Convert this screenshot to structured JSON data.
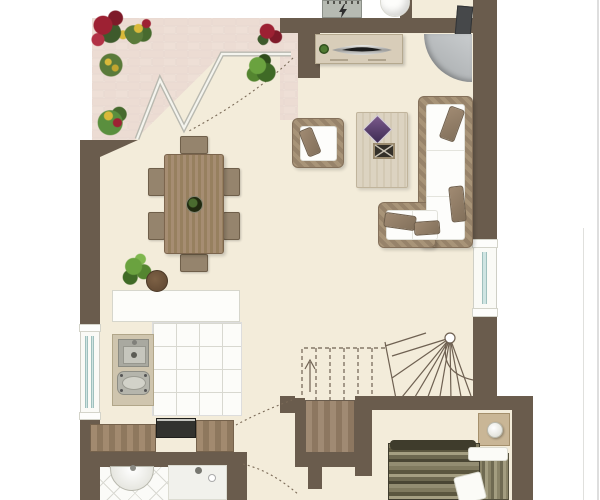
{
  "image_type": "architectural floor plan, top-down furnished, no text labels",
  "floorplan": {
    "rooms": [
      {
        "name": "terrace",
        "position": "top-left",
        "features": [
          "brick-paving",
          "flower-planters",
          "folding-glass-door",
          "door-swing-arc"
        ]
      },
      {
        "name": "living-dining-room",
        "position": "center",
        "features": [
          "dining-table-with-6-chairs",
          "table-centerpiece-plant",
          "armchair",
          "coffee-table",
          "l-shaped-sectional-sofa",
          "tv-sideboard",
          "corner-fireplace-with-flue",
          "potted-plant",
          "round-pot"
        ]
      },
      {
        "name": "kitchen",
        "position": "left-lower",
        "features": [
          "white-counter-block",
          "sink-counter-with-cooktop",
          "square-tiled-floor",
          "lower-wood-counters",
          "dark-appliance",
          "left-wall-window"
        ]
      },
      {
        "name": "bathroom",
        "position": "bottom-left",
        "features": [
          "diagonal-tiled-floor",
          "semicircular-washbasin",
          "shower-with-drain"
        ]
      },
      {
        "name": "hallway-stairs",
        "position": "bottom-center",
        "features": [
          "winder-staircase",
          "dashed-upper-flight",
          "up-arrow",
          "newel-post",
          "under-stair-wood-step",
          "door-swing-arcs"
        ]
      },
      {
        "name": "bedroom",
        "position": "bottom-right",
        "features": [
          "double-bed-striped-blanket",
          "white-pillows",
          "nightstand",
          "ball-lamp"
        ]
      },
      {
        "name": "entry-porch",
        "position": "top-right",
        "features": [
          "round-column",
          "electric-meter-box"
        ]
      }
    ],
    "symbols": [
      {
        "name": "electric-meter",
        "glyph": "lightning-bolt"
      },
      {
        "name": "stair-direction",
        "glyph": "arrow-up"
      },
      {
        "name": "door-swing",
        "glyph": "dashed-arc"
      },
      {
        "name": "window",
        "glyph": "double-blue-line-in-white-frame"
      }
    ],
    "colors": {
      "background": "#ffffff",
      "wall": "#6a5c4d",
      "floor_cream": "#f3ecda",
      "terrace_brick": "#ecdcd3",
      "brick_mortar": "#f8f2ea",
      "dark_wood": "#9b8468",
      "light_wood": "#dcd3c1",
      "wicker": "#a89478",
      "cushion_white": "#fdfdfb",
      "pillow_brown": "#8d7862",
      "window_glass": "#cfe4e2",
      "fireplace_gray": "#b7babc",
      "bed_stripe_dark": "#4a4634",
      "bed_stripe_light": "#a59f82",
      "plant_green": "#5f8f3e",
      "flower_red": "#9d2133",
      "flower_yellow": "#d9b93a",
      "tile_line": "#d8d8d0"
    },
    "counts": {
      "dining_chairs": 6,
      "sofa_pillows": 4,
      "terrace_plants": 6,
      "doors_with_swing_arcs": 3,
      "windows": 2
    }
  }
}
